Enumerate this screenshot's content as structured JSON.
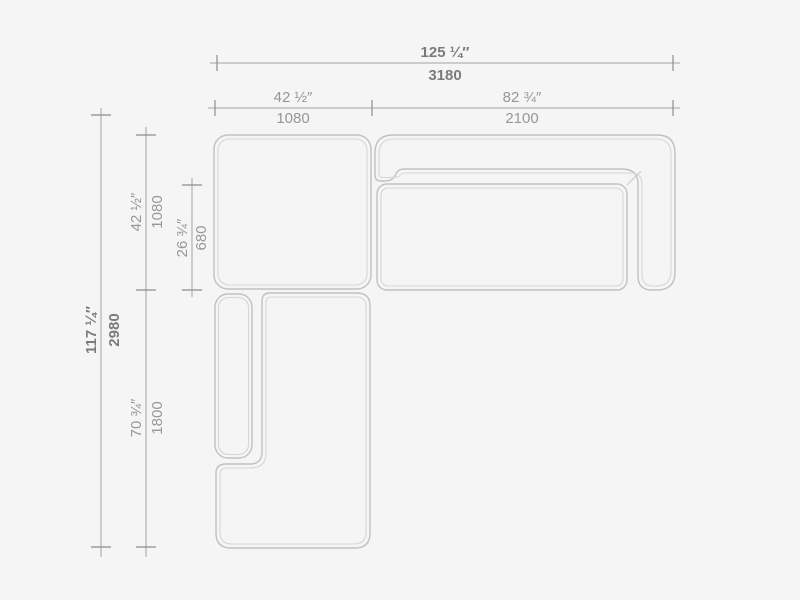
{
  "drawing": {
    "type": "sectional-sofa-top-view-dimension-drawing",
    "units": [
      "inches",
      "mm"
    ]
  },
  "dimensions": {
    "overall_width": {
      "inches": "125 ¼″",
      "mm": "3180"
    },
    "module_a_width": {
      "inches": "42 ½″",
      "mm": "1080"
    },
    "module_b_width": {
      "inches": "82 ¾″",
      "mm": "2100"
    },
    "overall_depth": {
      "inches": "117 ¼″",
      "mm": "2980"
    },
    "module_a_depth": {
      "inches": "42 ½″",
      "mm": "1080"
    },
    "seat_depth": {
      "inches": "26 ¾″",
      "mm": "680"
    },
    "chaise_length": {
      "inches": "70 ¾″",
      "mm": "1800"
    }
  },
  "colors": {
    "background": "#f5f5f5",
    "outline": "#c1c1c1",
    "outline_inner": "#d6d6d6",
    "dimension_line": "#a4a4a4",
    "tick": "#8d8d8d",
    "label": "#979797",
    "label_strong": "#7b7b7b"
  }
}
